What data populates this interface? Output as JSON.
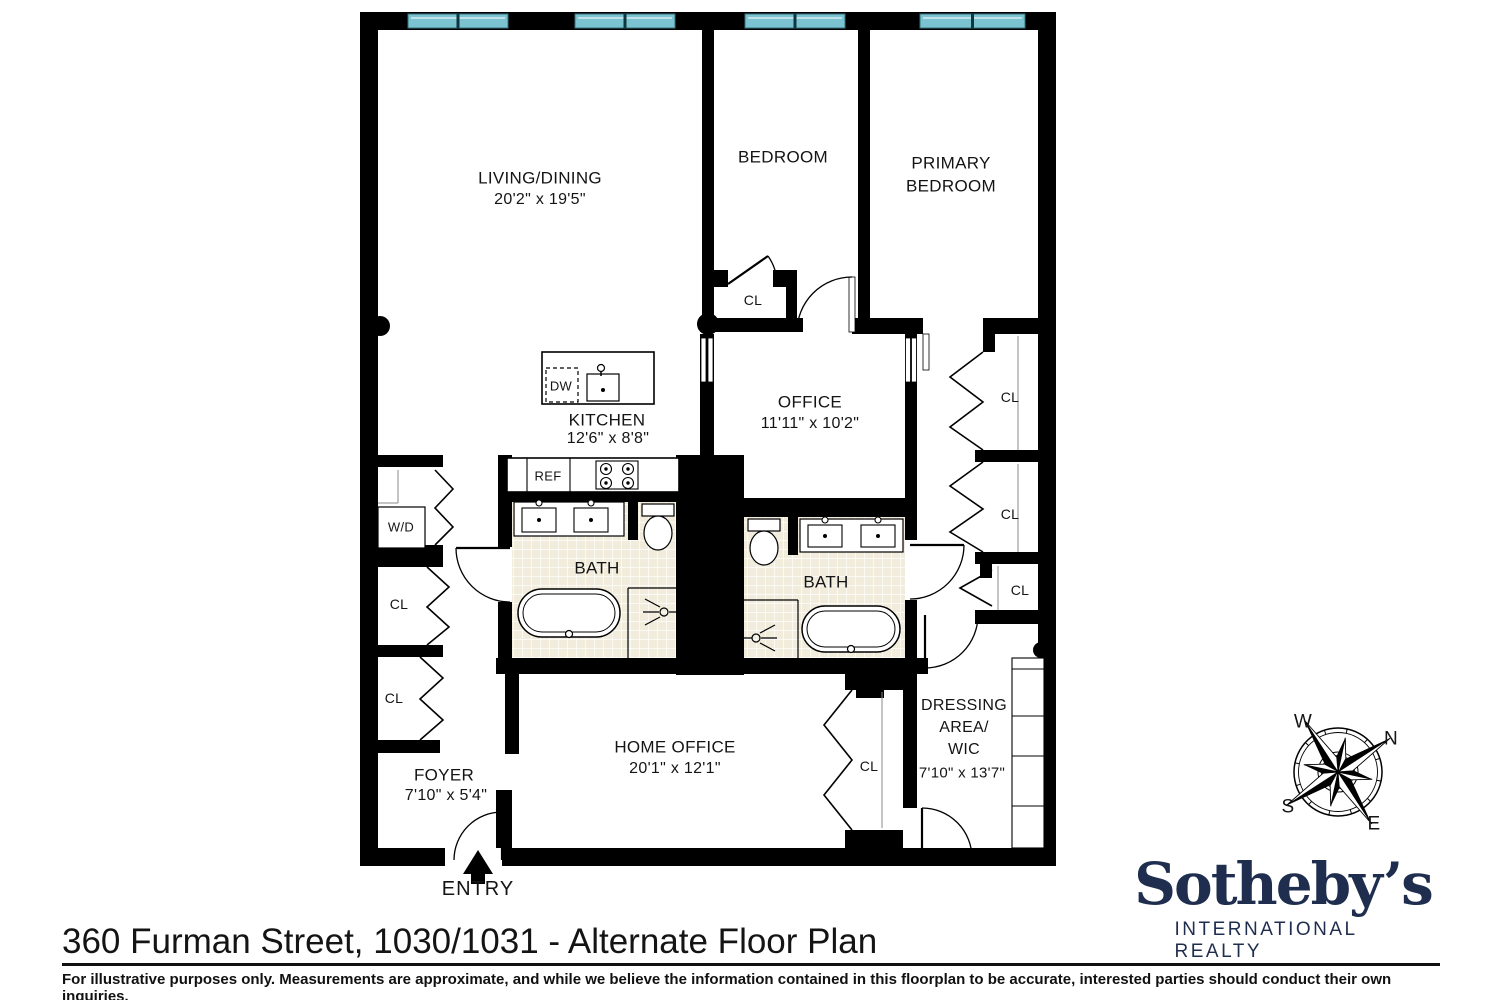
{
  "floorplan": {
    "rooms": {
      "living_dining": {
        "name": "LIVING/DINING",
        "dims": "20'2\" x 19'5\""
      },
      "bedroom": {
        "name": "BEDROOM"
      },
      "primary_bedroom": {
        "line1": "PRIMARY",
        "line2": "BEDROOM"
      },
      "office": {
        "name": "OFFICE",
        "dims": "11'11\" x 10'2\""
      },
      "kitchen": {
        "name": "KITCHEN",
        "dims": "12'6\" x 8'8\""
      },
      "bath_left": {
        "name": "BATH"
      },
      "bath_right": {
        "name": "BATH"
      },
      "home_office": {
        "name": "HOME OFFICE",
        "dims": "20'1\" x 12'1\""
      },
      "foyer": {
        "name": "FOYER",
        "dims": "7'10\" x 5'4\""
      },
      "dressing_area": {
        "line1": "DRESSING",
        "line2": "AREA/",
        "line3": "WIC",
        "dims": "7'10\" x 13'7\""
      }
    },
    "closets": {
      "bedroom_cl": "CL",
      "hall_cl_upper": "CL",
      "hall_cl_lower": "CL",
      "right_cl_1": "CL",
      "right_cl_2": "CL",
      "right_cl_3": "CL",
      "home_office_cl": "CL"
    },
    "fixtures": {
      "washer_dryer": "W/D",
      "refrigerator": "REF",
      "dishwasher": "DW"
    },
    "entry_label": "ENTRY",
    "window_color": "#7cc3d1"
  },
  "compass": {
    "north": "N",
    "south": "S",
    "east": "E",
    "west": "W"
  },
  "branding": {
    "name": "Sotheby’s",
    "tagline": "INTERNATIONAL REALTY",
    "color": "#1f2e4e"
  },
  "footer": {
    "title": "360 Furman Street, 1030/1031 - Alternate Floor Plan",
    "disclaimer": "For illustrative purposes only.  Measurements are approximate, and while we believe the information contained in this floorplan to be accurate, interested parties should conduct their own inquiries."
  }
}
